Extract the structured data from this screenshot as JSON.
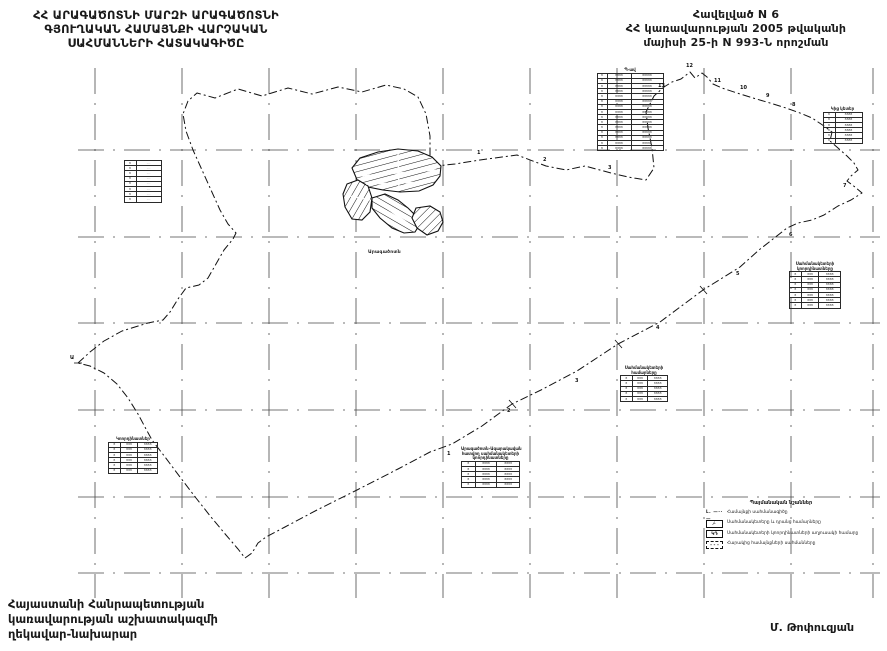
{
  "header_left": {
    "lines": [
      "ՀՀ ԱՐԱԳԱԾՈՏՆԻ ՄԱՐԶԻ ԱՐԱԳԱԾՈՏՆԻ",
      "ԳՅՈՒՂԱԿԱՆ ՀԱՄԱՅՆՔԻ ՎԱՐՉԱԿԱՆ",
      "ՍԱՀՄԱՆՆԵՐԻ ՀԱՏԱԿԱԳԻԾԸ"
    ]
  },
  "header_right": {
    "lines": [
      "Հավելված N 6",
      "ՀՀ կառավարության 2005 թվականի",
      "մայիսի 25-ի N 993-Ն որոշման"
    ]
  },
  "footer_left": {
    "lines": [
      "Հայաստանի Հանրապետության",
      "կառավարության աշխատակազմի",
      "ղեկավար-նախարար"
    ]
  },
  "signature": "Մ. Թոփուզյան",
  "map": {
    "settlement_label": "Արագածոտն",
    "colors": {
      "ink": "#1a1a1a",
      "paper": "#ffffff"
    },
    "point_labels": [
      {
        "x": 70,
        "y": 356,
        "t": "Ա"
      },
      {
        "x": 477,
        "y": 151,
        "t": "1"
      },
      {
        "x": 543,
        "y": 158,
        "t": "2"
      },
      {
        "x": 608,
        "y": 166,
        "t": "3"
      },
      {
        "x": 658,
        "y": 84,
        "t": "13"
      },
      {
        "x": 686,
        "y": 64,
        "t": "12"
      },
      {
        "x": 714,
        "y": 79,
        "t": "11"
      },
      {
        "x": 740,
        "y": 86,
        "t": "10"
      },
      {
        "x": 766,
        "y": 94,
        "t": "9"
      },
      {
        "x": 792,
        "y": 103,
        "t": "8"
      },
      {
        "x": 843,
        "y": 184,
        "t": "7"
      },
      {
        "x": 789,
        "y": 233,
        "t": "6"
      },
      {
        "x": 736,
        "y": 272,
        "t": "5"
      },
      {
        "x": 656,
        "y": 326,
        "t": "4"
      },
      {
        "x": 575,
        "y": 379,
        "t": "3"
      },
      {
        "x": 507,
        "y": 409,
        "t": "2"
      },
      {
        "x": 447,
        "y": 452,
        "t": "1"
      }
    ],
    "tables": [
      {
        "x": 596,
        "y": 68,
        "w": 68,
        "title_lines": [
          "Պ-ավ"
        ],
        "rows": 15,
        "cols": [
          {
            "w": 8,
            "fill": "8"
          },
          {
            "w": 22,
            "fill": "8888"
          },
          {
            "w": 30,
            "fill": "88888"
          }
        ]
      },
      {
        "x": 821,
        "y": 107,
        "w": 43,
        "title_lines": [
          "Կից կետեր"
        ],
        "rows": 6,
        "cols": [
          {
            "w": 10,
            "fill": "8"
          },
          {
            "w": 25,
            "fill": "8888"
          }
        ]
      },
      {
        "x": 789,
        "y": 262,
        "w": 52,
        "title_lines": [
          "Սահմանակետերի",
          "կոորդինատները"
        ],
        "rows": 7,
        "cols": [
          {
            "w": 10,
            "fill": "8"
          },
          {
            "w": 16,
            "fill": "888"
          },
          {
            "w": 20,
            "fill": "8888"
          }
        ]
      },
      {
        "x": 620,
        "y": 366,
        "w": 48,
        "title_lines": [
          "Սահմանակետերի",
          "համարները"
        ],
        "rows": 5,
        "cols": [
          {
            "w": 10,
            "fill": "8"
          },
          {
            "w": 14,
            "fill": "888"
          },
          {
            "w": 18,
            "fill": "8888"
          }
        ]
      },
      {
        "x": 461,
        "y": 447,
        "w": 59,
        "title_lines": [
          "Արագածոտն-Ագարակավան",
          "հատվող սահմանակետերի",
          "կոորդինատները"
        ],
        "rows": 5,
        "cols": [
          {
            "w": 12,
            "fill": "8"
          },
          {
            "w": 20,
            "fill": "8888"
          },
          {
            "w": 21,
            "fill": "8888"
          }
        ]
      },
      {
        "x": 123,
        "y": 160,
        "w": 39,
        "title_lines": [],
        "rows": 8,
        "cols": [
          {
            "w": 10,
            "fill": "8"
          },
          {
            "w": 23,
            "fill": "····"
          }
        ]
      },
      {
        "x": 108,
        "y": 437,
        "w": 50,
        "title_lines": [
          "Կոորդինատներ"
        ],
        "rows": 6,
        "cols": [
          {
            "w": 10,
            "fill": "8"
          },
          {
            "w": 16,
            "fill": "888"
          },
          {
            "w": 18,
            "fill": "8888"
          }
        ]
      }
    ]
  },
  "legend": {
    "title": "Պայմանական նշաններ",
    "items": [
      {
        "symbol": "boundary-line",
        "symbol_text": "Լ. —··—",
        "label": "Համայնքի սահմանագիծը"
      },
      {
        "symbol": "box-point",
        "symbol_text": "⁄·",
        "label": "Սահմանակետերը և դրանց համարները"
      },
      {
        "symbol": "box-table",
        "symbol_text": "ԿԴ",
        "label": "Սահմանակետերի կոորդինատների աղյուսակի համարը"
      },
      {
        "symbol": "box-dashed",
        "symbol_text": "- - -",
        "label": "Հարակից համայնքների սահմանները"
      }
    ]
  }
}
